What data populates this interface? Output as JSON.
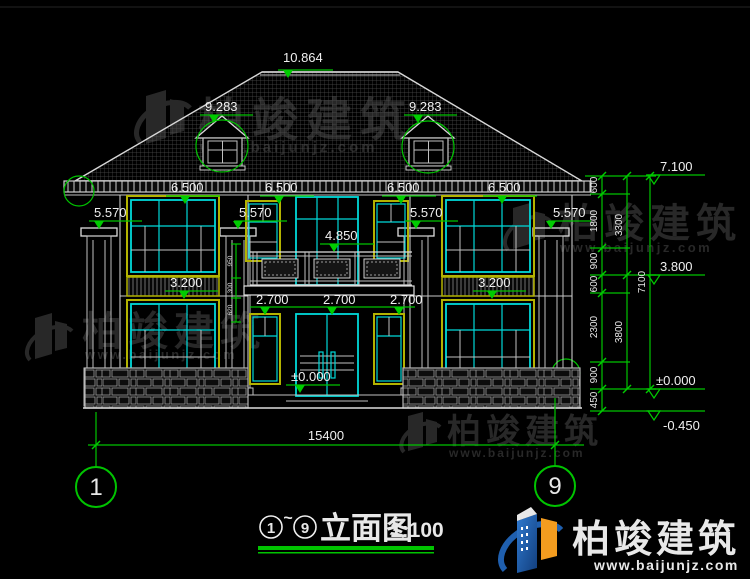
{
  "el": {
    "ridge": "10.864",
    "dormer": "9.283",
    "eave": "7.100",
    "head2": "6.500",
    "cap": "5.570",
    "balcony": "4.850",
    "floor2": "3.800",
    "band": "3.200",
    "head1": "2.700",
    "zero": "±0.000",
    "neg": "-0.450"
  },
  "dims": {
    "chain1": [
      "600",
      "1800",
      "900",
      "600",
      "2300",
      "900",
      "450"
    ],
    "chain2": [
      "3300",
      "3800"
    ],
    "total_height": "7100",
    "total_width": "15400",
    "railing": [
      "950",
      "300",
      "620"
    ]
  },
  "grid": {
    "left": "1",
    "right": "9"
  },
  "title": {
    "circle_left": "1",
    "tilde": "~",
    "circle_right": "9",
    "text": "立面图",
    "scale": "1:100"
  },
  "watermark": {
    "cn": "柏竣建筑",
    "url": "www.baijunjz.com"
  },
  "brand": {
    "cn": "柏竣建筑",
    "url": "www.baijunjz.com"
  },
  "colors": {
    "dimension_green": "#00c400",
    "window_cyan": "#00d9d9",
    "frame_yellow": "#b3b300",
    "line_white": "#dedede",
    "brand_blue": "#1f5fae",
    "brand_orange": "#f39c1f"
  }
}
